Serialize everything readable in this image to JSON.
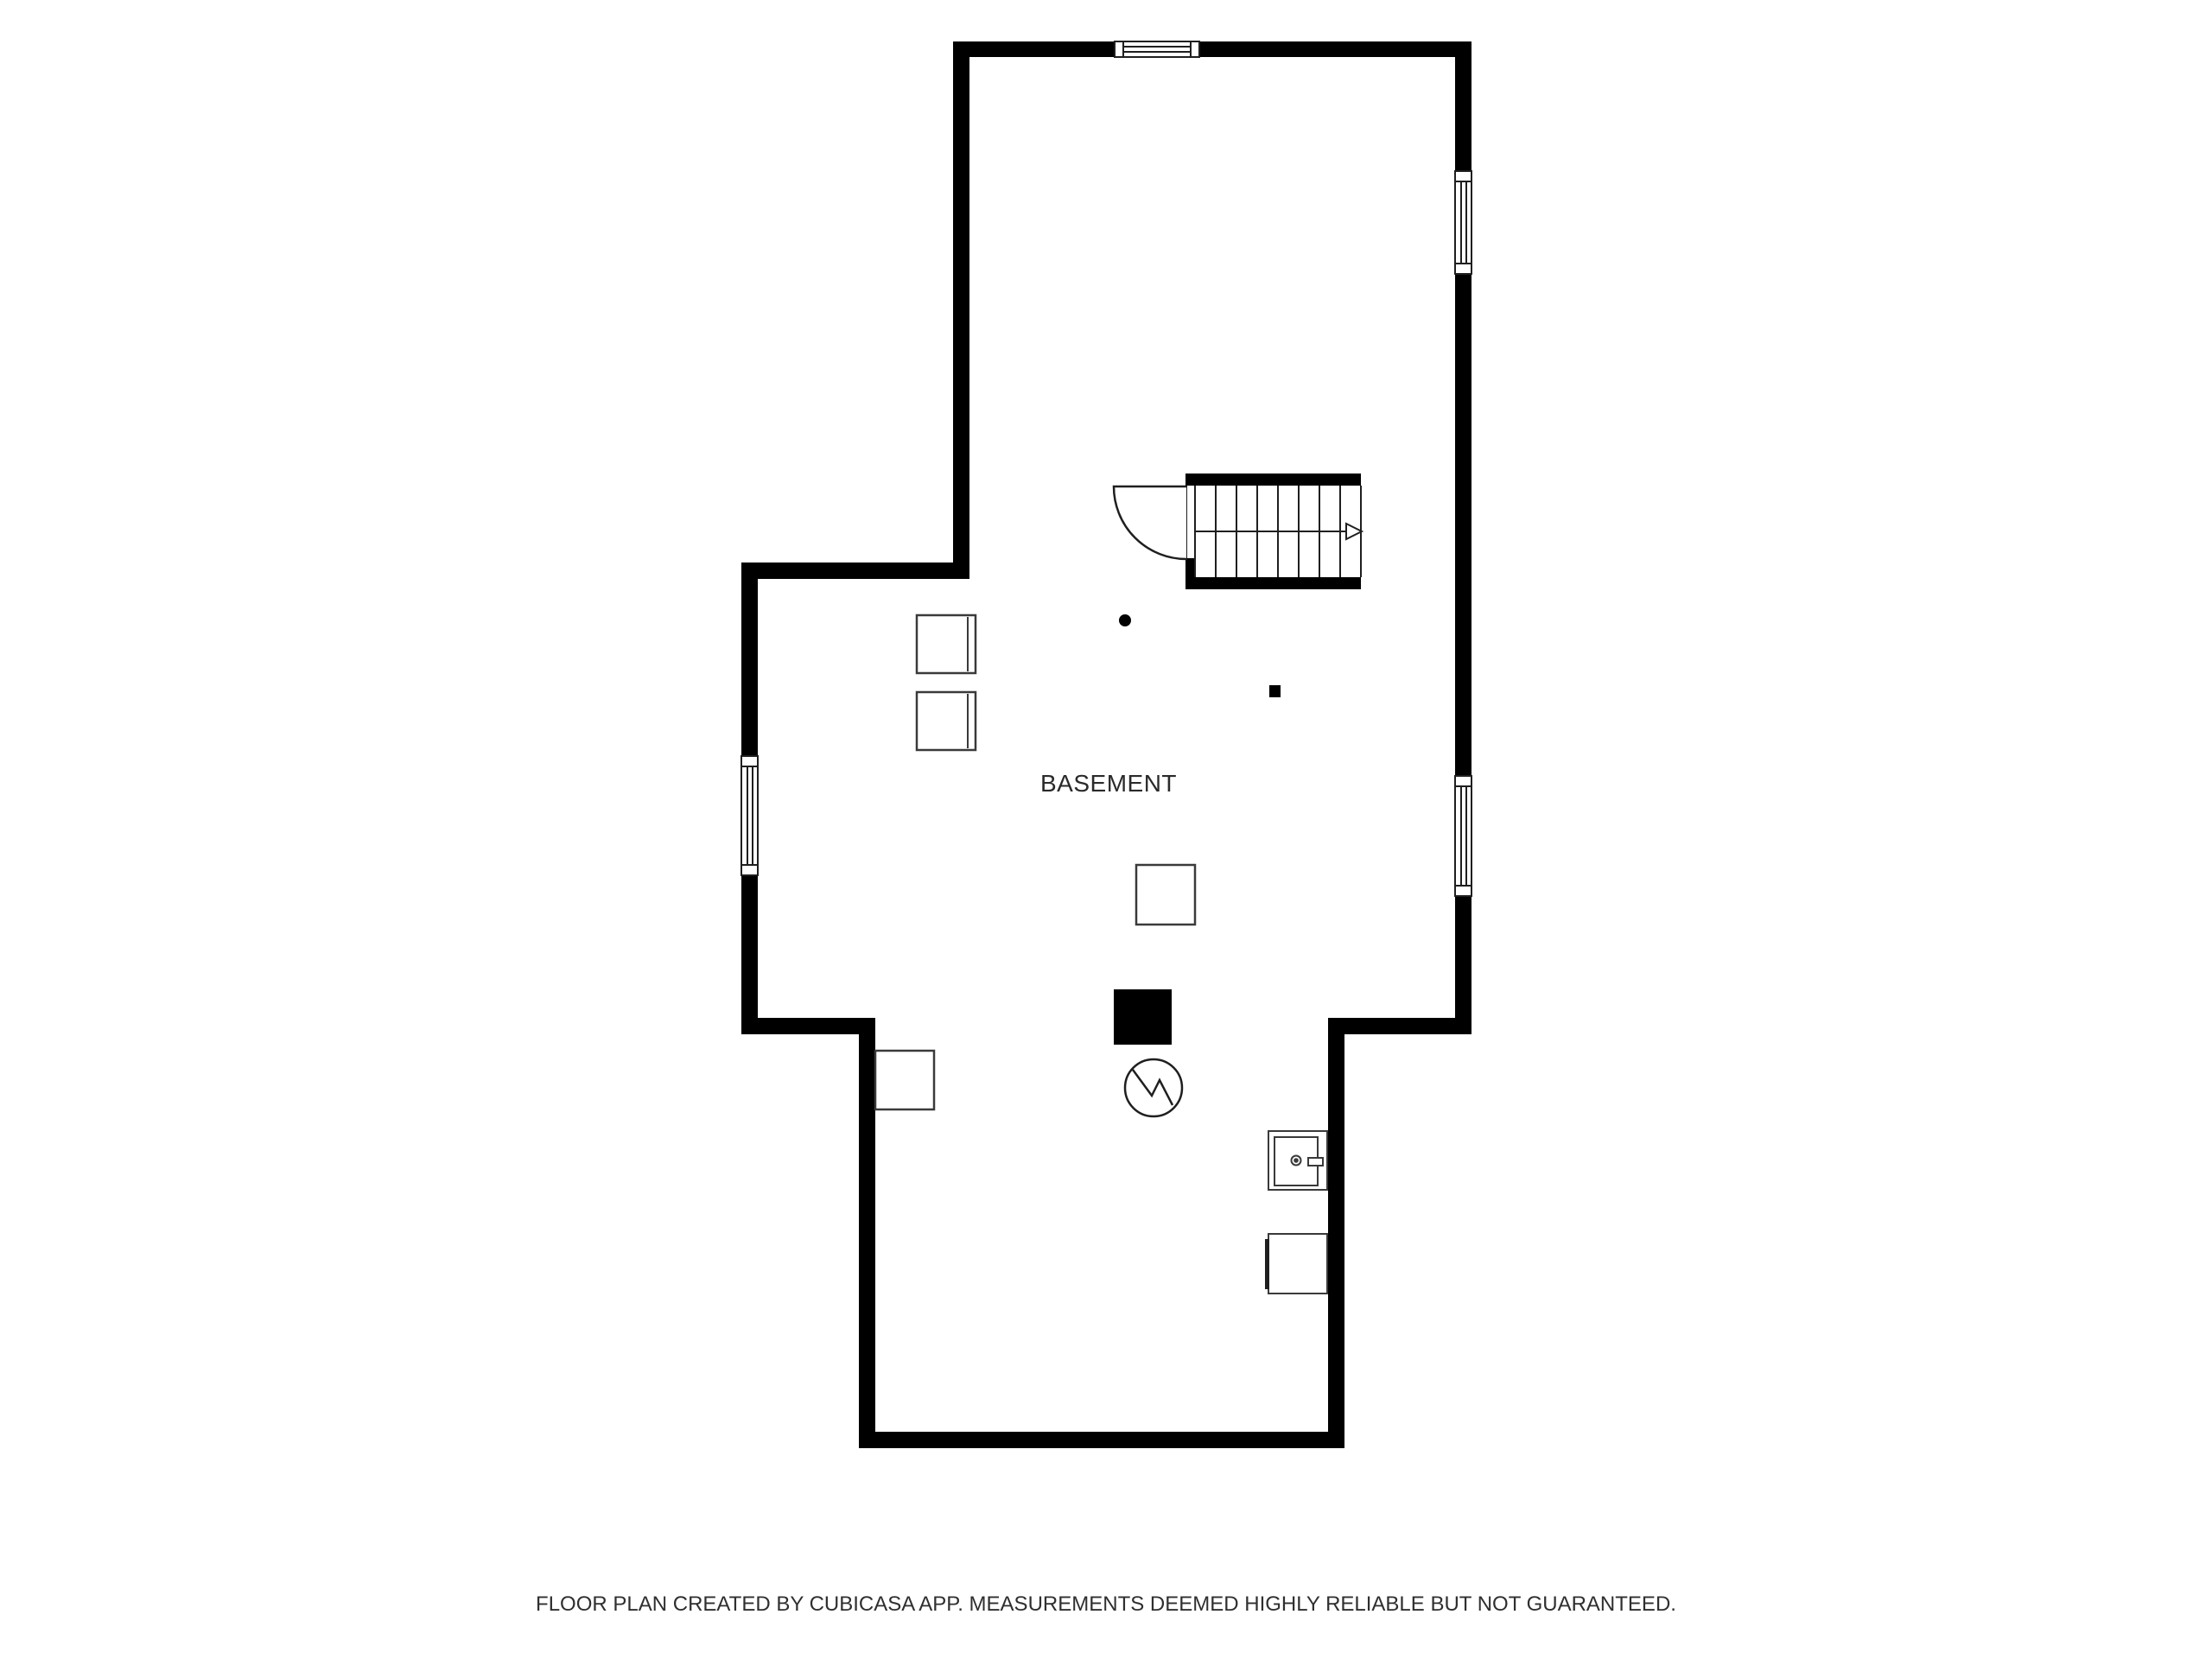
{
  "floor_plan": {
    "room_label": "BASEMENT",
    "footer_text": "FLOOR PLAN CREATED BY CUBICASA APP. MEASUREMENTS DEEMED HIGHLY RELIABLE BUT NOT GUARANTEED.",
    "colors": {
      "background": "#ffffff",
      "wall": "#000000",
      "fixture_outline": "#3a3a3a",
      "window_frame": "#1f1f1f",
      "room_label_text": "#2a2a2a",
      "footer_text": "#2f2f2f"
    },
    "symbols": [
      "staircase-up-arrow",
      "door-swing-arc",
      "window-top",
      "window-left",
      "window-right-upper",
      "window-right-lower",
      "appliance-box-1",
      "appliance-box-2",
      "wall-dot-marker",
      "small-wall-box",
      "storage-box",
      "equipment-box-black",
      "pump-circle-symbol",
      "utility-sink",
      "appliance-box-3",
      "corner-box"
    ]
  }
}
